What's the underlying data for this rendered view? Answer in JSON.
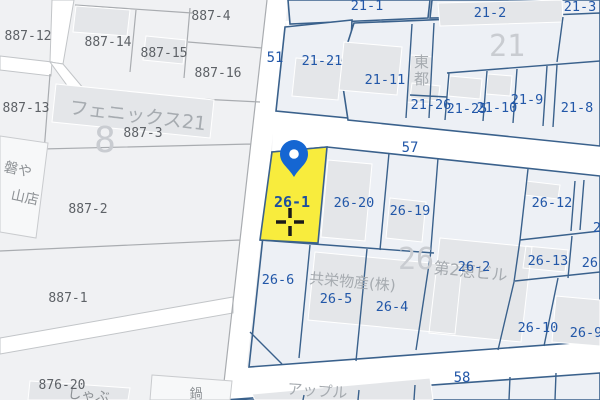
{
  "selected_parcel": {
    "lot": "26-1"
  },
  "roads": {
    "r51": "51",
    "r57": "57",
    "r58": "58"
  },
  "blocks": {
    "b8": "8",
    "b21": "21",
    "b26": "26"
  },
  "lots": {
    "887-12": "887-12",
    "887-14": "887-14",
    "887-15": "887-15",
    "887-4": "887-4",
    "887-16": "887-16",
    "887-13": "887-13",
    "887-3": "887-3",
    "887-2": "887-2",
    "887-1": "887-1",
    "876-20": "876-20",
    "21-1": "21-1",
    "21-2": "21-2",
    "21-3": "21-3",
    "21-21": "21-21",
    "21-11": "21-11",
    "21-26": "21-26",
    "21-25": "21-25",
    "21-10": "21-10",
    "21-9": "21-9",
    "21-8": "21-8",
    "26-1": "26-1",
    "26-20": "26-20",
    "26-19": "26-19",
    "26-12": "26-12",
    "26-13": "26-13",
    "26-10": "26-10",
    "26-9": "26-9",
    "26-2": "26-2",
    "26-6": "26-6",
    "26-5": "26-5",
    "26-4": "26-4",
    "partial-2": "2",
    "partial-26": "26-"
  },
  "building_names": {
    "phoenix": "フェニックス21",
    "todo": "東都",
    "kyoei": "共栄物産(株)",
    "dai2": "第2恵ビル",
    "apple": "アップル",
    "iwa": "磐や",
    "yamaten": "山店",
    "shabu": "しゃぶ",
    "nabe": "鍋"
  },
  "colors": {
    "highlight": "#F8EC3D",
    "pin": "#1566D2",
    "parcel_line_blue": "#3A618C",
    "parcel_line_gray": "#A9ACB0",
    "lot_text_blue": "#2257A8",
    "lot_text_gray": "#5E6267",
    "road_fill": "#FFFFFF",
    "base_fill": "#F0F1F3"
  }
}
